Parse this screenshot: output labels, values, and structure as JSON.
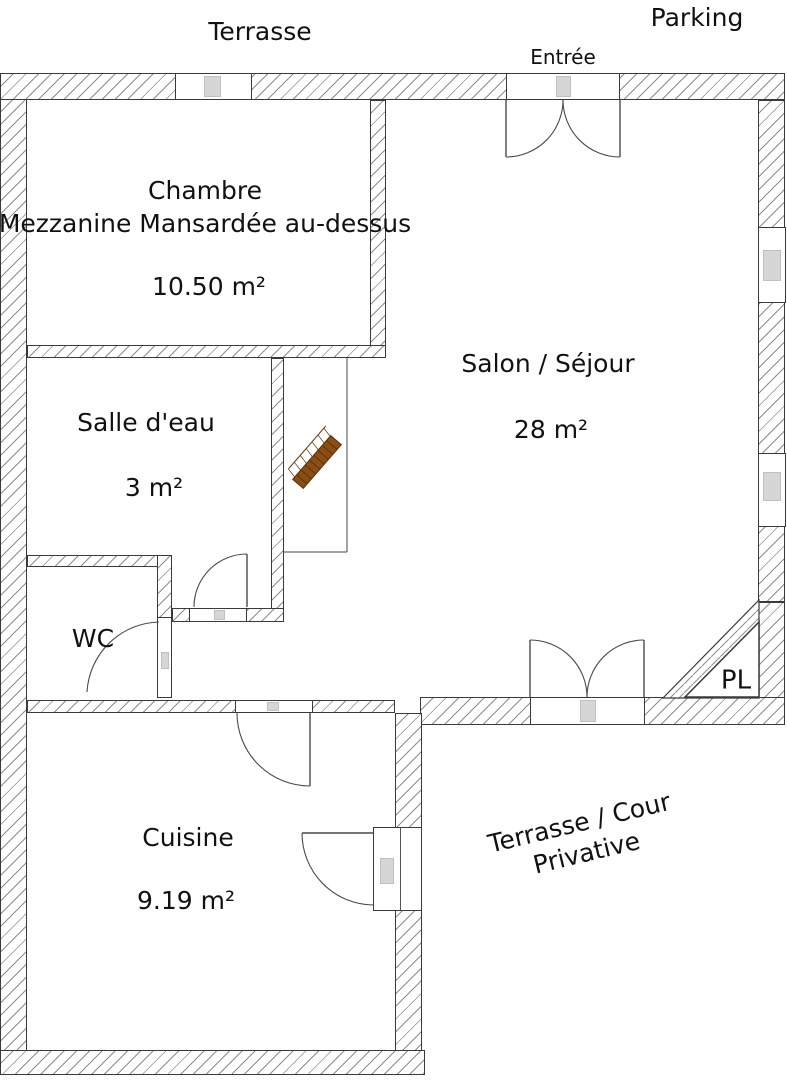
{
  "plan": {
    "exterior_labels": {
      "terrace_top": "Terrasse",
      "parking": "Parking",
      "entrance": "Entrée",
      "terrace_court": {
        "line1": "Terrasse / Cour",
        "line2": "Privative"
      }
    },
    "rooms": {
      "chambre": {
        "name": "Chambre",
        "note": "Mezzanine Mansardée au-dessus",
        "area": "10.50 m²"
      },
      "salon": {
        "name": "Salon / Séjour",
        "area": "28 m²"
      },
      "salle_deau": {
        "name": "Salle d'eau",
        "area": "3 m²"
      },
      "wc": {
        "name": "WC"
      },
      "cuisine": {
        "name": "Cuisine",
        "area": "9.19 m²"
      },
      "placard": {
        "abbr": "PL"
      }
    },
    "colors": {
      "wall_outline": "#3a3a3a",
      "hatch_line": "#8d8d8d",
      "stair_wood": "#8a4d15",
      "fixture_gray": "#d6d6d6"
    }
  }
}
